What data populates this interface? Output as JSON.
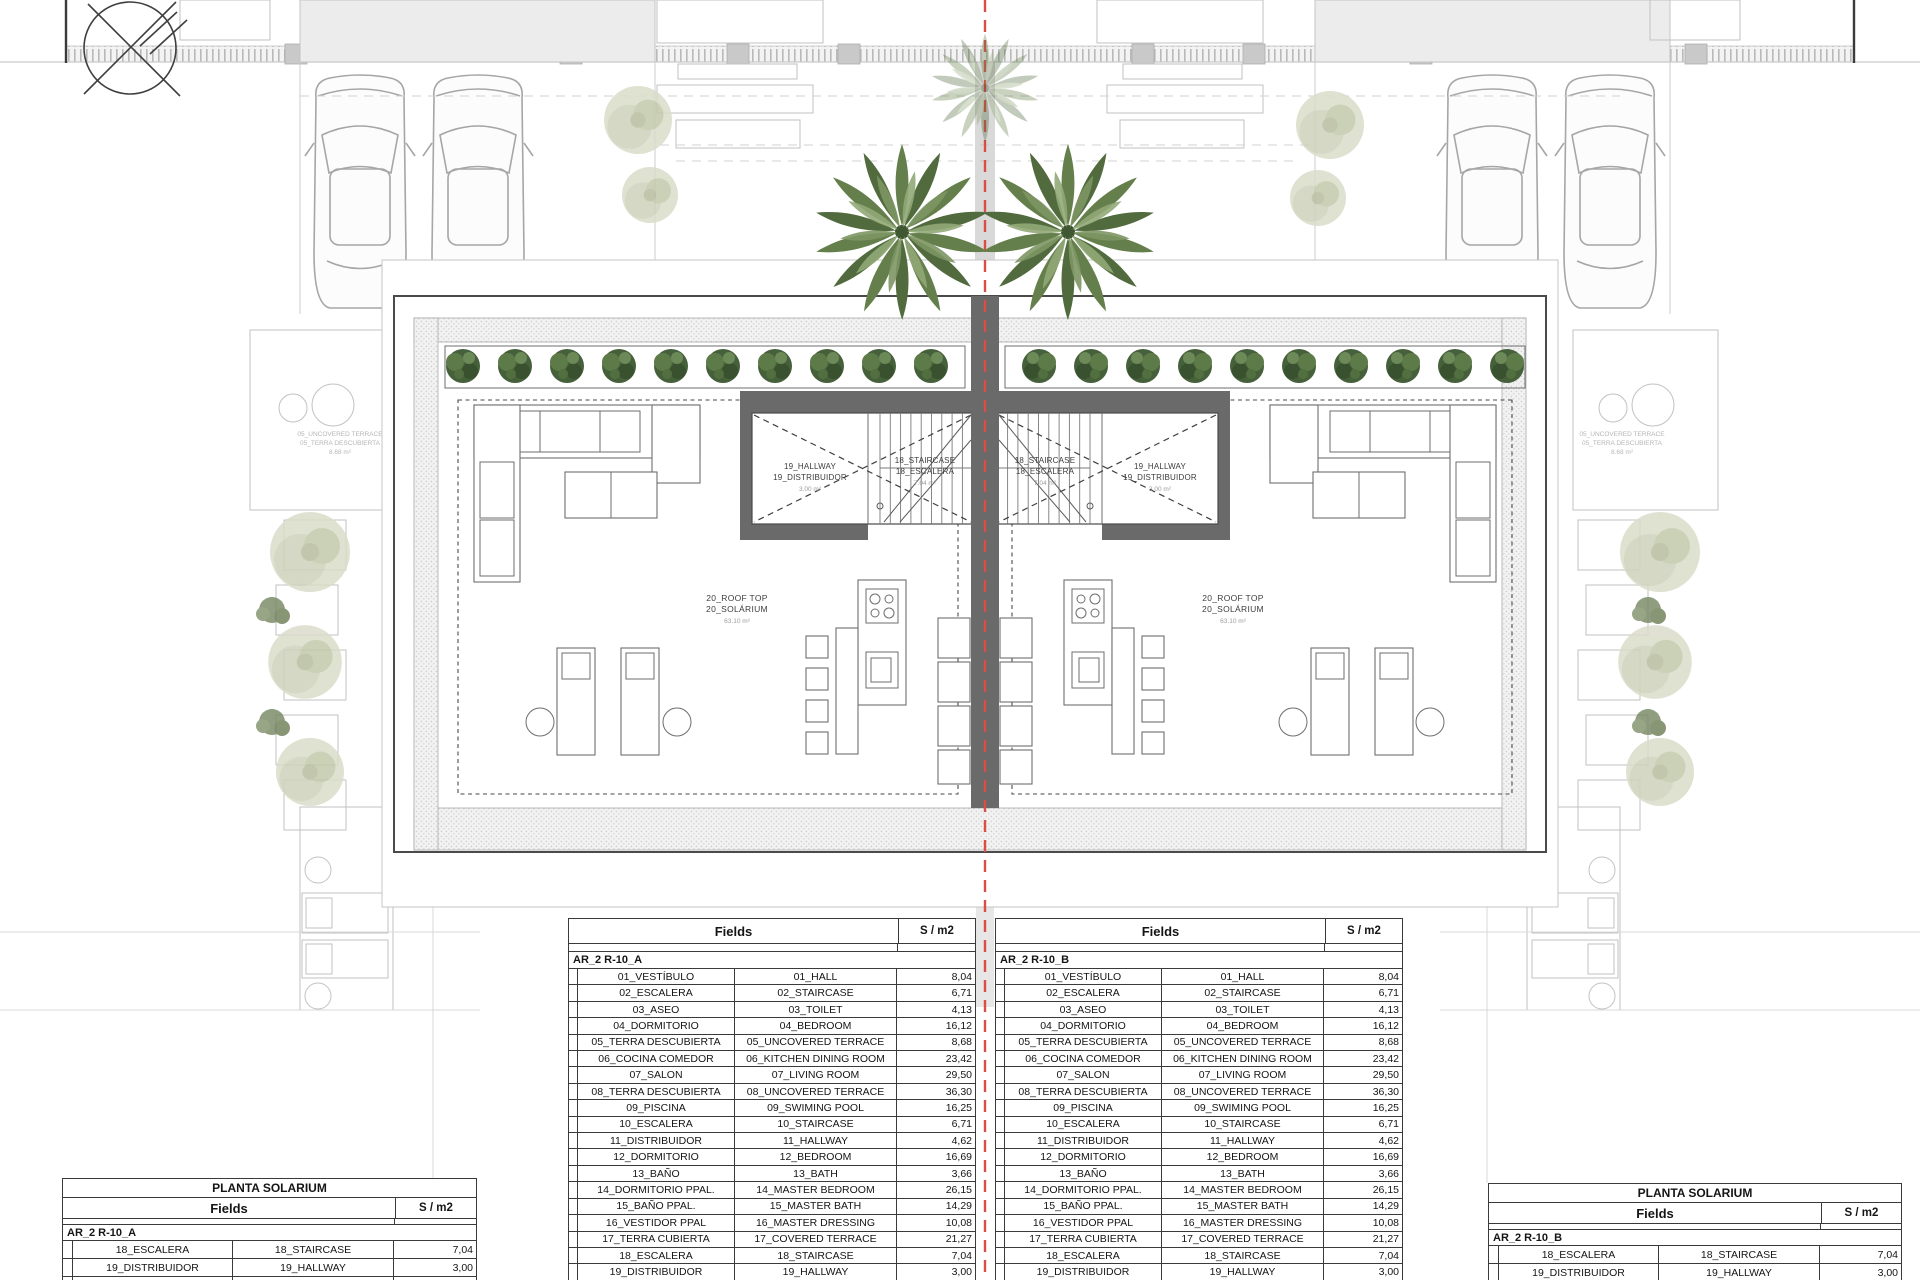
{
  "sheet": {
    "centerline_color": "#d94f43",
    "north_symbol": "north-arrow"
  },
  "plan": {
    "units": [
      {
        "name": "AR_2 R-10_A",
        "hallway": [
          "19_HALLWAY",
          "19_DISTRIBUIDOR",
          "3.00 m²"
        ],
        "staircase": [
          "18_STAIRCASE",
          "18_ESCALERA",
          "7.04 m²"
        ],
        "roof": [
          "20_ROOF TOP",
          "20_SOLÁRIUM",
          "63.10 m²"
        ]
      },
      {
        "name": "AR_2 R-10_B",
        "hallway": [
          "19_HALLWAY",
          "19_DISTRIBUIDOR",
          "3.00 m²"
        ],
        "staircase": [
          "18_STAIRCASE",
          "18_ESCALERA",
          "7.04 m²"
        ],
        "roof": [
          "20_ROOF TOP",
          "20_SOLÁRIUM",
          "63.10 m²"
        ]
      }
    ],
    "neighbor_terrace": [
      "05_UNCOVERED TERRACE",
      "05_TERRA DESCUBIERTA",
      "8.68 m²"
    ]
  },
  "tables": {
    "fields_header": "Fields",
    "area_header": "S / m2",
    "group_a": "AR_2 R-10_A",
    "group_b": "AR_2 R-10_B",
    "rows": [
      {
        "es": "01_VESTÍBULO",
        "en": "01_HALL",
        "m2": "8,04"
      },
      {
        "es": "02_ESCALERA",
        "en": "02_STAIRCASE",
        "m2": "6,71"
      },
      {
        "es": "03_ASEO",
        "en": "03_TOILET",
        "m2": "4,13"
      },
      {
        "es": "04_DORMITORIO",
        "en": "04_BEDROOM",
        "m2": "16,12"
      },
      {
        "es": "05_TERRA DESCUBIERTA",
        "en": "05_UNCOVERED TERRACE",
        "m2": "8,68"
      },
      {
        "es": "06_COCINA COMEDOR",
        "en": "06_KITCHEN DINING ROOM",
        "m2": "23,42"
      },
      {
        "es": "07_SALON",
        "en": "07_LIVING ROOM",
        "m2": "29,50"
      },
      {
        "es": "08_TERRA DESCUBIERTA",
        "en": "08_UNCOVERED TERRACE",
        "m2": "36,30"
      },
      {
        "es": "09_PISCINA",
        "en": "09_SWIMING POOL",
        "m2": "16,25"
      },
      {
        "es": "10_ESCALERA",
        "en": "10_STAIRCASE",
        "m2": "6,71"
      },
      {
        "es": "11_DISTRIBUIDOR",
        "en": "11_HALLWAY",
        "m2": "4,62"
      },
      {
        "es": "12_DORMITORIO",
        "en": "12_BEDROOM",
        "m2": "16,69"
      },
      {
        "es": "13_BAÑO",
        "en": "13_BATH",
        "m2": "3,66"
      },
      {
        "es": "14_DORMITORIO PPAL.",
        "en": "14_MASTER BEDROOM",
        "m2": "26,15"
      },
      {
        "es": "15_BAÑO PPAL.",
        "en": "15_MASTER BATH",
        "m2": "14,29"
      },
      {
        "es": "16_VESTIDOR PPAL",
        "en": "16_MASTER DRESSING",
        "m2": "10,08"
      },
      {
        "es": "17_TERRA CUBIERTA",
        "en": "17_COVERED TERRACE",
        "m2": "21,27"
      },
      {
        "es": "18_ESCALERA",
        "en": "18_STAIRCASE",
        "m2": "7,04"
      },
      {
        "es": "19_DISTRIBUIDOR",
        "en": "19_HALLWAY",
        "m2": "3,00"
      }
    ],
    "solarium": {
      "title": "PLANTA SOLARIUM",
      "rows": [
        {
          "es": "18_ESCALERA",
          "en": "18_STAIRCASE",
          "m2": "7,04"
        },
        {
          "es": "19_DISTRIBUIDOR",
          "en": "19_HALLWAY",
          "m2": "3,00"
        }
      ]
    }
  }
}
